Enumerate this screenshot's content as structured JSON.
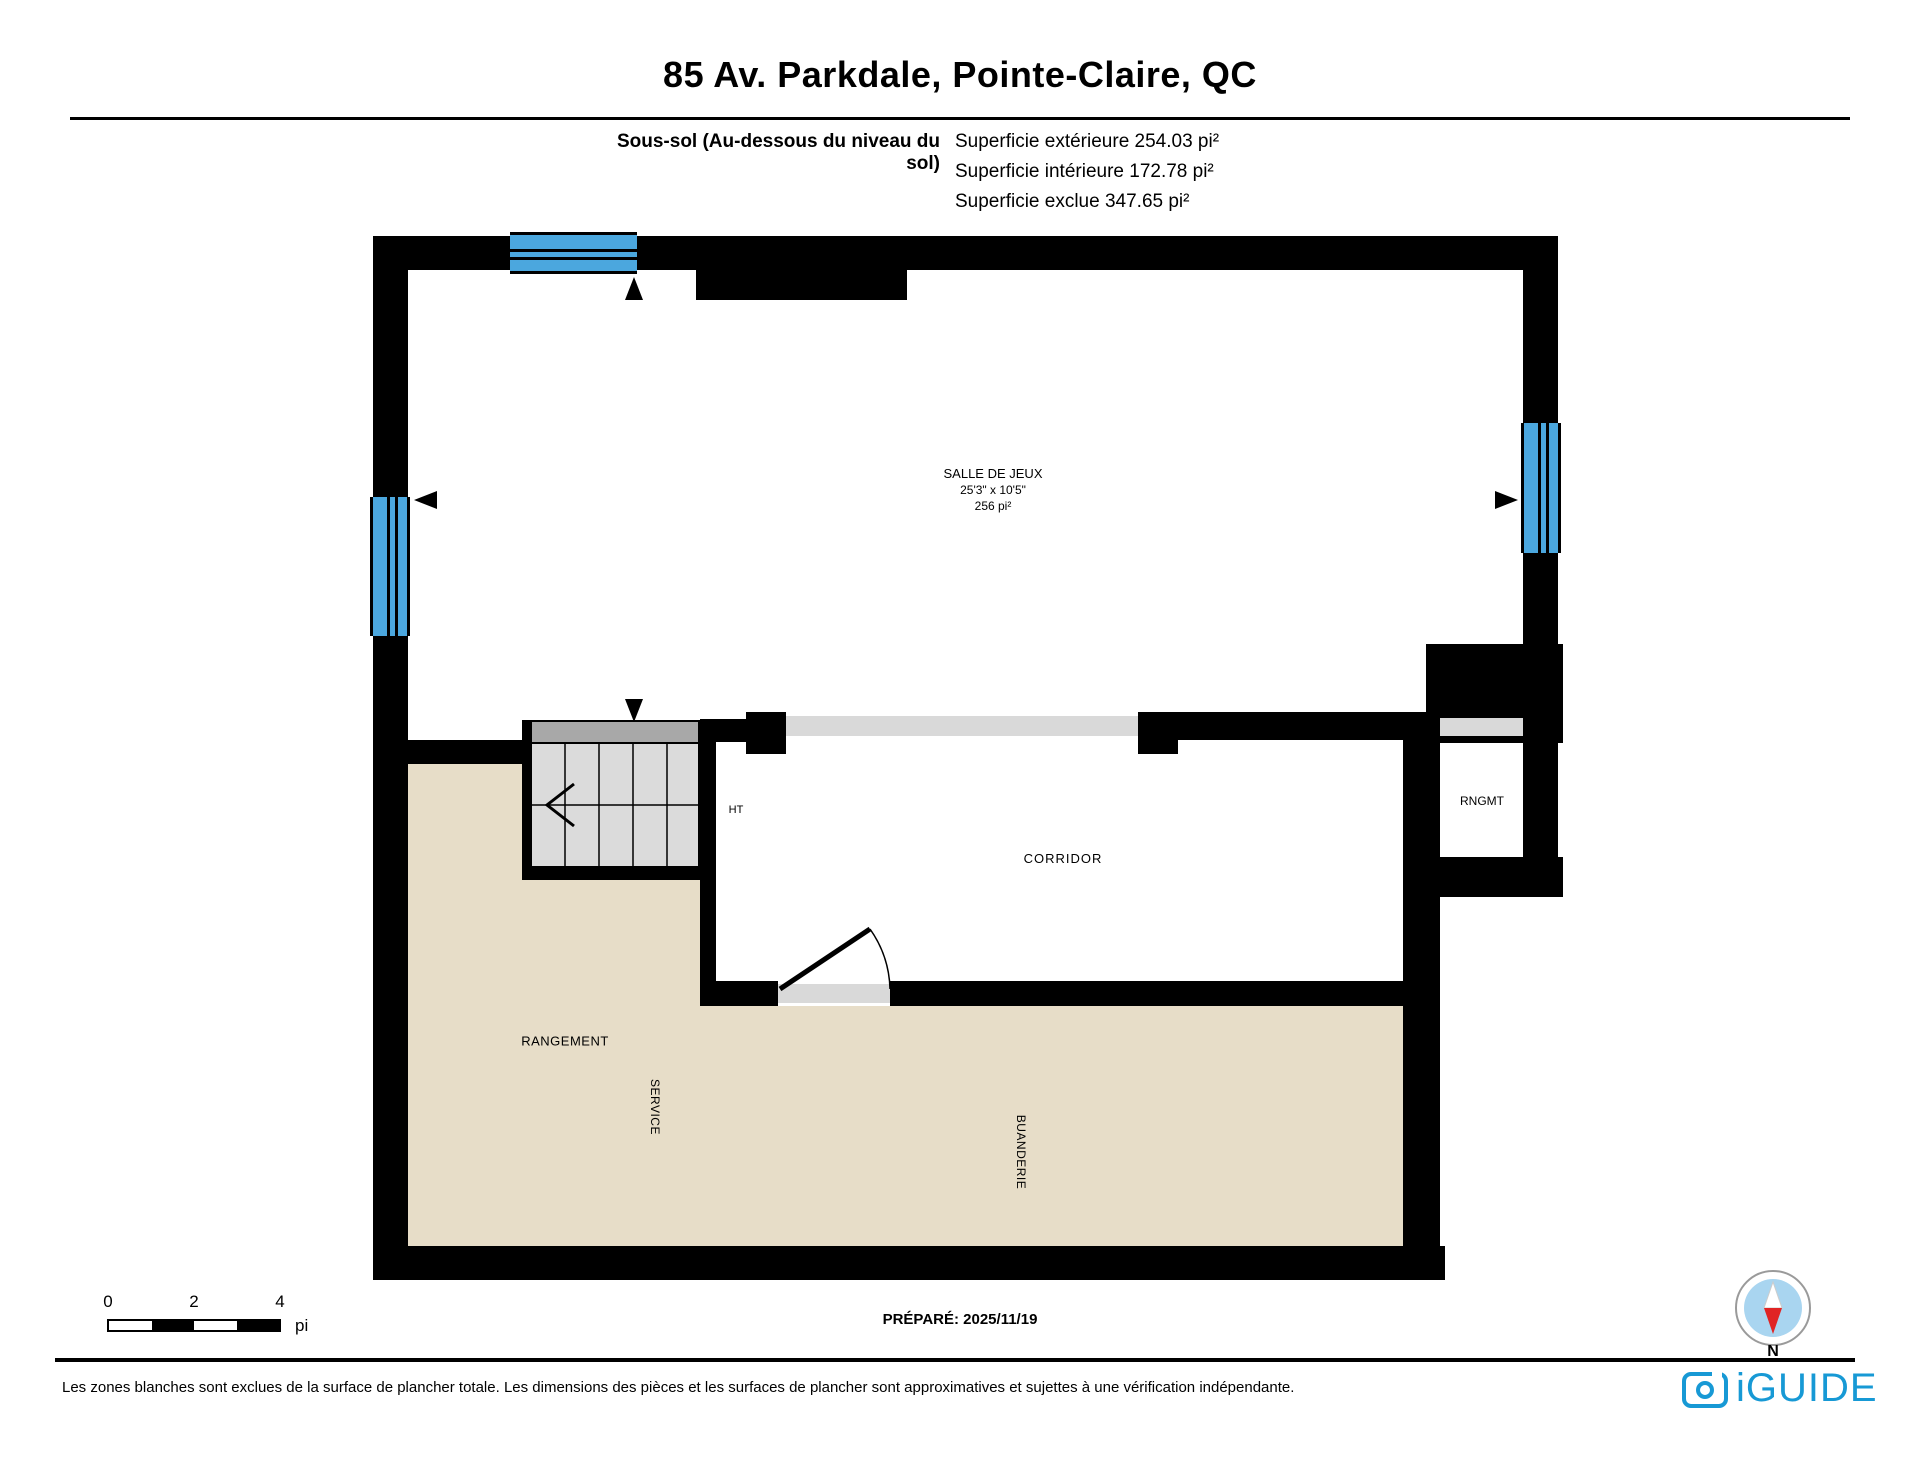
{
  "header": {
    "title": "85 Av. Parkdale, Pointe-Claire, QC",
    "floor_label": "Sous-sol (Au-dessous du niveau du sol)",
    "area_lines": [
      "Superficie extérieure 254.03 pi²",
      "Superficie intérieure 172.78 pi²",
      "Superficie exclue 347.65 pi²"
    ]
  },
  "rooms": {
    "salle_de_jeux": {
      "name": "SALLE DE JEUX",
      "dimensions": "25'3\" x 10'5\"",
      "area": "256 pi²"
    },
    "corridor": {
      "name": "CORRIDOR"
    },
    "rngmt": {
      "name": "RNGMT"
    },
    "ht": {
      "name": "HT"
    },
    "rangement": {
      "name": "RANGEMENT"
    },
    "service": {
      "name": "SERVICE"
    },
    "buanderie": {
      "name": "BUANDERIE"
    }
  },
  "scale_bar": {
    "tick_start": "0",
    "tick_mid": "2",
    "tick_end": "4",
    "unit": "pi"
  },
  "footer": {
    "prepared": "PRÉPARÉ: 2025/11/19",
    "disclaimer": "Les zones blanches sont exclues de la surface de plancher totale. Les dimensions des pièces et les surfaces de plancher sont approximatives et sujettes à une vérification indépendante.",
    "north": "N",
    "brand": "iGUIDE"
  },
  "colors": {
    "window": "#4BA7DE",
    "excluded": "#E7DDC8",
    "opening": "#D9D9D9",
    "stairs_tread": "#DBDBDB",
    "stairs_landing": "#A8A8A8",
    "brand": "#1799D5",
    "compass_fill": "#A9D5F0",
    "compass_needle_red": "#E02424"
  }
}
